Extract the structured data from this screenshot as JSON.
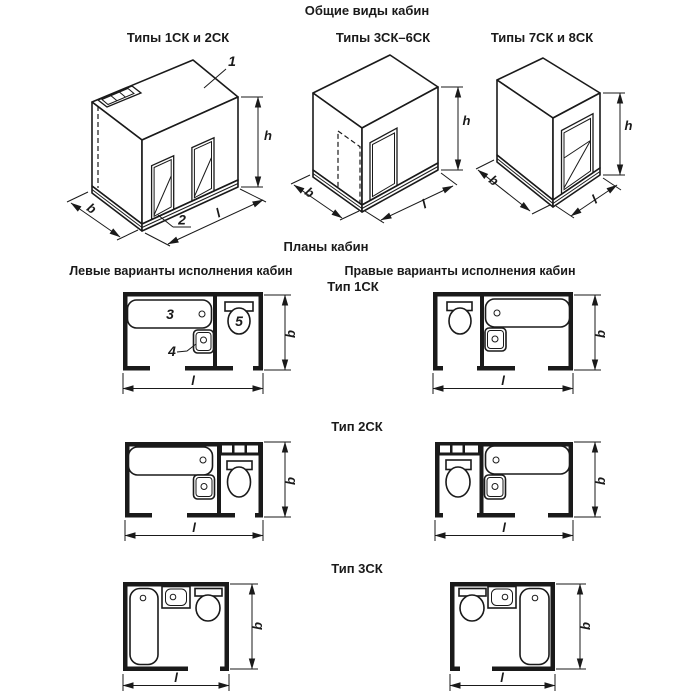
{
  "title": "Общие виды кабин",
  "iso": {
    "views": [
      {
        "label": "Типы 1СК и 2СК",
        "callout_ceiling": "1",
        "callout_base": "2",
        "dim_h": "h",
        "dim_b": "b",
        "dim_l": "l"
      },
      {
        "label": "Типы 3СК–6СК",
        "dim_h": "h",
        "dim_b": "b",
        "dim_l": "l"
      },
      {
        "label": "Типы 7СК и 8СК",
        "dim_h": "h",
        "dim_b": "b",
        "dim_l": "l"
      }
    ]
  },
  "plans": {
    "title": "Планы кабин",
    "left_header": "Левые варианты исполнения кабин",
    "right_header": "Правые варианты исполнения кабин",
    "rows": [
      {
        "type_label": "Тип 1СК",
        "callout_bathtub": "3",
        "callout_washbasin": "4",
        "callout_toilet": "5",
        "dim_b": "b",
        "dim_l": "l"
      },
      {
        "type_label": "Тип 2СК",
        "dim_b": "b",
        "dim_l": "l"
      },
      {
        "type_label": "Тип 3СК",
        "dim_b": "b",
        "dim_l": "l"
      }
    ]
  },
  "colors": {
    "ink": "#1a1a1a",
    "background": "#ffffff"
  }
}
